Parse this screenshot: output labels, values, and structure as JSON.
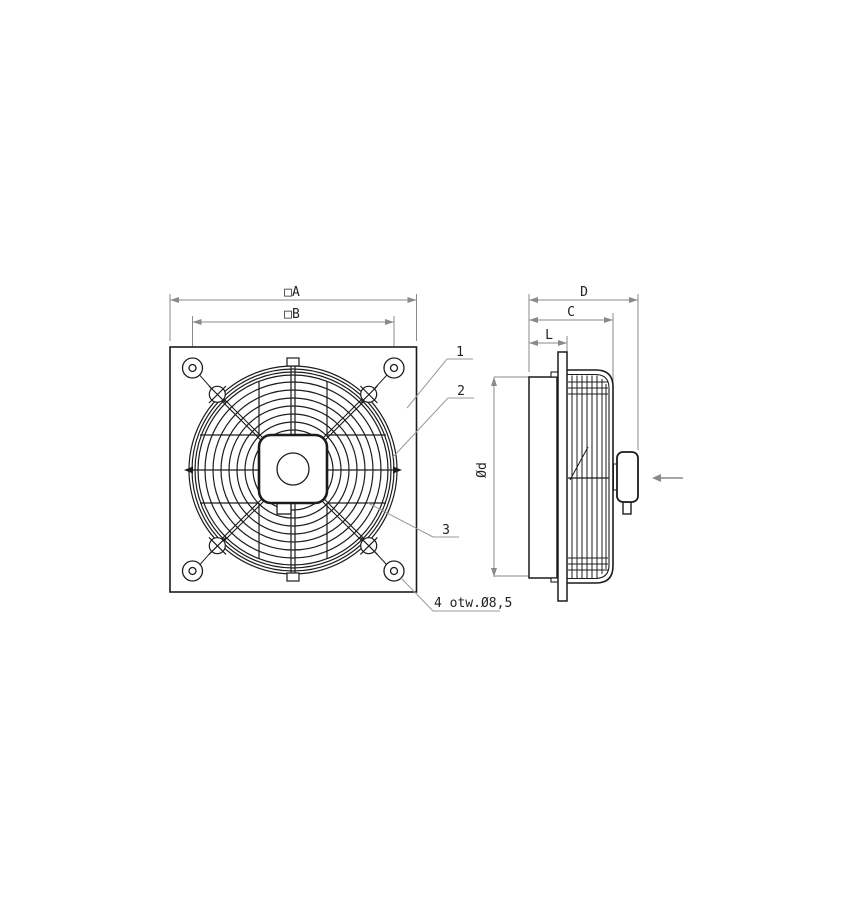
{
  "front_view": {
    "dim_outer_square": "□A",
    "dim_hole_spacing": "□B",
    "callout_1": "1",
    "callout_2": "2",
    "callout_3": "3",
    "holes_note": "4 otw.Ø8,5"
  },
  "side_view": {
    "dim_total_depth": "D",
    "dim_guard_depth": "C",
    "dim_motor_depth": "L",
    "dim_impeller_diameter": "Ød"
  },
  "colors": {
    "line_main": "#1c1c1c",
    "line_dimension": "#8a8a8a",
    "background": "#ffffff",
    "text": "#222222"
  }
}
